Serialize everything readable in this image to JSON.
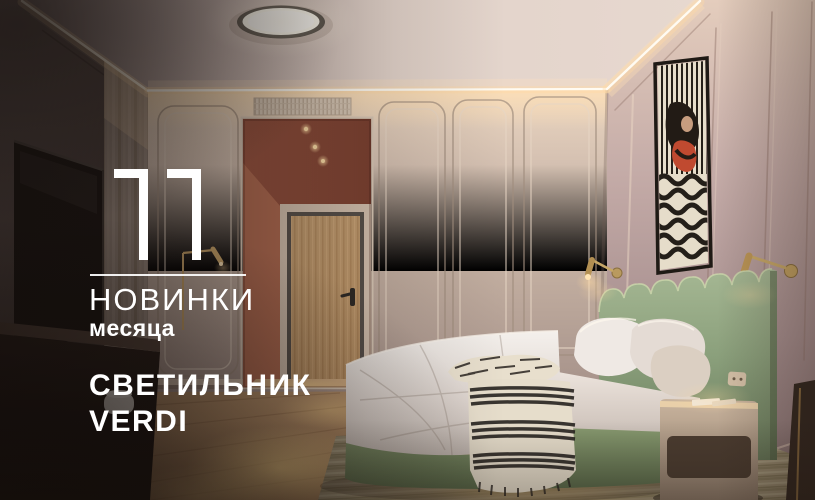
{
  "overlay": {
    "number": "11",
    "heading": "НОВИНКИ",
    "subheading": "месяца",
    "product_line1": "СВЕТИЛЬНИК",
    "product_line2": "VERDI",
    "text_color": "#ffffff"
  },
  "scene_colors": {
    "hallway_terracotta": "#ab614a",
    "wall_beige": "#cdb9ab",
    "wall_mauve": "#bda5a3",
    "headboard_sage": "#8da17d",
    "brass_accent": "#c6a263",
    "artwork_red": "#c04a30",
    "floor_wood": "#bb9069",
    "rug_olive": "#aba081",
    "cove_light": "#fff3da"
  }
}
